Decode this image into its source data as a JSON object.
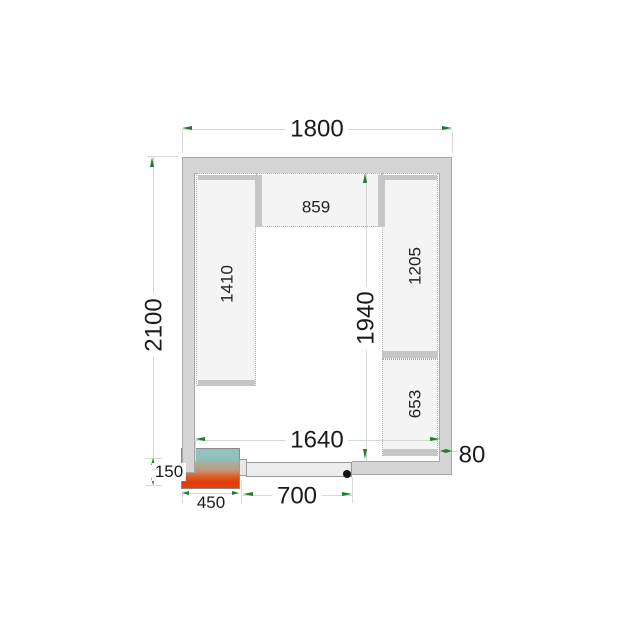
{
  "plan": {
    "kind": "cold-room-floor-plan",
    "dims": {
      "outer_width": "1800",
      "outer_depth": "2100",
      "inner_width": "1640",
      "inner_depth": "1940",
      "wall_thickness": "80",
      "door_width": "700",
      "unit_width": "450",
      "unit_depth": "150"
    },
    "shelves": {
      "top": "859",
      "left": "1410",
      "right_upper": "1205",
      "right_lower": "653"
    },
    "colors": {
      "arrow_green": "#1f7d2c",
      "wall_gray": "#d5d5d5",
      "unit_gradient_top": "#8fc3c4",
      "unit_gradient_bottom": "#e2420c"
    }
  }
}
